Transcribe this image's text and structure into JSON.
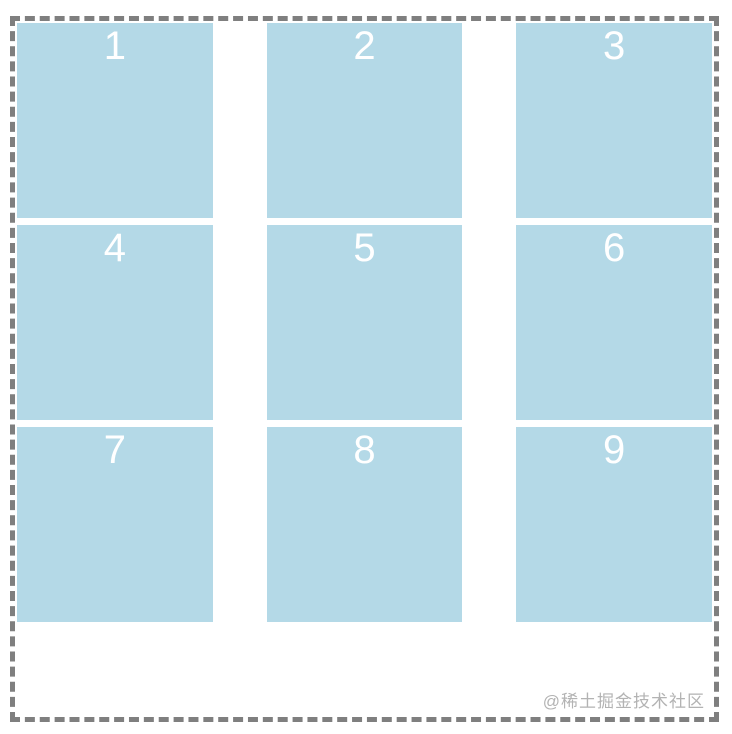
{
  "grid": {
    "items": [
      {
        "label": "1"
      },
      {
        "label": "2"
      },
      {
        "label": "3"
      },
      {
        "label": "4"
      },
      {
        "label": "5"
      },
      {
        "label": "6"
      },
      {
        "label": "7"
      },
      {
        "label": "8"
      },
      {
        "label": "9"
      }
    ]
  },
  "watermark": {
    "text": "@稀土掘金技术社区"
  },
  "colors": {
    "box": "#b4d9e7",
    "border": "#7f7f7f",
    "number": "#ffffff",
    "watermark": "#b3b3b3"
  }
}
